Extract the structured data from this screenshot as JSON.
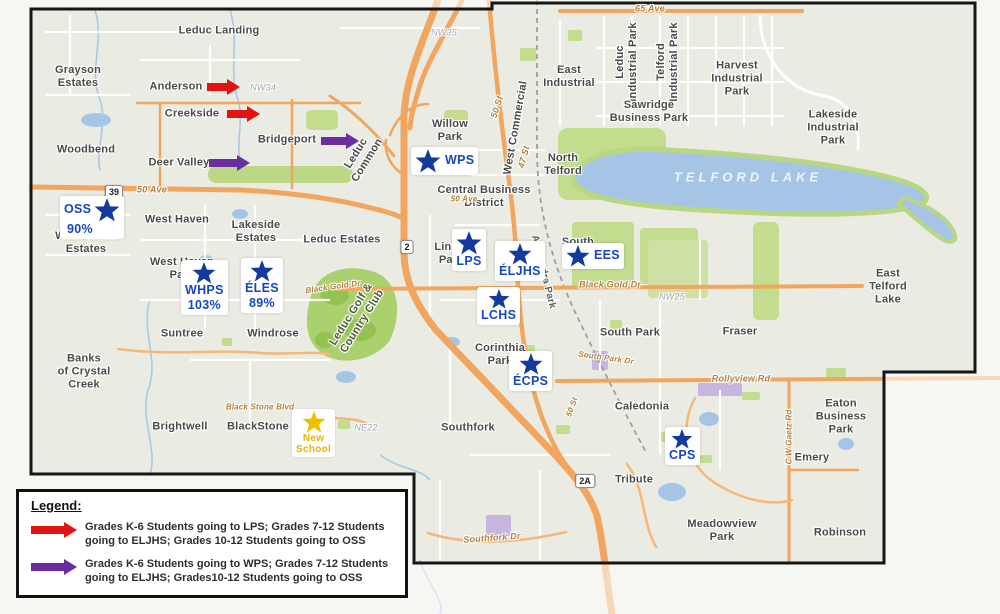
{
  "legend": {
    "title": "Legend:",
    "items": [
      {
        "color_name": "red",
        "arrow_color": "#e11414",
        "text": "Grades K-6 Students going to LPS; Grades 7-12 Students going to ELJHS; Grades 10-12 Students going to OSS"
      },
      {
        "color_name": "purple",
        "arrow_color": "#6b2ea0",
        "text": "Grades K-6 Students going to WPS; Grades 7-12 Students going to ELJHS; Grades10-12 Students going to OSS"
      }
    ]
  },
  "colors": {
    "school_blue": "#1646c6",
    "star_blue": "#143a9e",
    "new_school_yellow": "#f0c000",
    "new_school_text": "#e9b400",
    "arrow_red": "#e11414",
    "arrow_purple": "#6b2ea0",
    "highway_orange": "#f2a55e",
    "water_blue": "#a6c5e6",
    "park_green": "#c3dc8e",
    "boundary_black": "#161616"
  },
  "schools": [
    {
      "id": "OSS",
      "label": "OSS",
      "pct": "90%",
      "x": 60,
      "y": 196,
      "layout": "star-right",
      "star": 26
    },
    {
      "id": "WPS",
      "label": "WPS",
      "x": 411,
      "y": 147,
      "layout": "star-left",
      "star": 26
    },
    {
      "id": "WHPS",
      "label": "WHPS",
      "pct": "103%",
      "x": 181,
      "y": 260,
      "layout": "col",
      "star": 24
    },
    {
      "id": "ELES",
      "label": "ÉLES",
      "pct": "89%",
      "x": 241,
      "y": 258,
      "layout": "col",
      "star": 24
    },
    {
      "id": "LPS",
      "label": "LPS",
      "x": 452,
      "y": 229,
      "layout": "col",
      "star": 26
    },
    {
      "id": "ELJHS",
      "label": "ÉLJHS",
      "x": 495,
      "y": 241,
      "layout": "col",
      "star": 24
    },
    {
      "id": "EES",
      "label": "EES",
      "x": 562,
      "y": 243,
      "layout": "star-left",
      "star": 24
    },
    {
      "id": "LCHS",
      "label": "LCHS",
      "x": 477,
      "y": 287,
      "layout": "col",
      "star": 22
    },
    {
      "id": "ECPS",
      "label": "ÉCPS",
      "x": 509,
      "y": 351,
      "layout": "col",
      "star": 24
    },
    {
      "id": "CPS",
      "label": "CPS",
      "x": 665,
      "y": 427,
      "layout": "col",
      "star": 22
    },
    {
      "id": "NEW",
      "label": "New\nSchool",
      "x": 292,
      "y": 409,
      "layout": "col",
      "star": 24,
      "variant": "yellow"
    }
  ],
  "map_arrows": [
    {
      "name": "anderson-route-arrow",
      "color": "#e11414",
      "x": 207,
      "y": 87,
      "len": 33
    },
    {
      "name": "creekside-route-arrow",
      "color": "#e11414",
      "x": 227,
      "y": 114,
      "len": 33
    },
    {
      "name": "bridgeport-route-arrow",
      "color": "#6b2ea0",
      "x": 321,
      "y": 141,
      "len": 38
    },
    {
      "name": "deer-valley-route-arrow",
      "color": "#6b2ea0",
      "x": 209,
      "y": 163,
      "len": 41
    }
  ],
  "shields": [
    {
      "t": "39",
      "x": 114,
      "y": 192
    },
    {
      "t": "2",
      "x": 407,
      "y": 247
    },
    {
      "t": "2A",
      "x": 585,
      "y": 481
    }
  ],
  "labels": [
    {
      "n": "leduc-landing",
      "t": "Leduc Landing",
      "x": 219,
      "y": 31
    },
    {
      "n": "grayson-estates",
      "t": "Grayson\nEstates",
      "x": 78,
      "y": 77
    },
    {
      "n": "anderson",
      "t": "Anderson",
      "x": 176,
      "y": 87
    },
    {
      "n": "creekside",
      "t": "Creekside",
      "x": 192,
      "y": 114
    },
    {
      "n": "bridgeport",
      "t": "Bridgeport",
      "x": 287,
      "y": 140
    },
    {
      "n": "deer-valley",
      "t": "Deer Valley",
      "x": 179,
      "y": 163
    },
    {
      "n": "woodbend",
      "t": "Woodbend",
      "x": 86,
      "y": 150
    },
    {
      "n": "leduc-common",
      "t": "Leduc\nCommon",
      "x": 362,
      "y": 157,
      "r": -58
    },
    {
      "n": "willow-park",
      "t": "Willow\nPark",
      "x": 450,
      "y": 131
    },
    {
      "n": "west-commercial",
      "t": "West Commercial",
      "x": 516,
      "y": 128,
      "r": -80
    },
    {
      "n": "east-industrial",
      "t": "East\nIndustrial",
      "x": 569,
      "y": 77
    },
    {
      "n": "leduc-industrial-park",
      "t": "Leduc\nIndustrial Park",
      "x": 627,
      "y": 62,
      "r": -90
    },
    {
      "n": "telford-industrial-park",
      "t": "Telford\nIndustrial Park",
      "x": 668,
      "y": 62,
      "r": -90
    },
    {
      "n": "sawridge-business-park",
      "t": "Sawridge\nBusiness Park",
      "x": 649,
      "y": 112
    },
    {
      "n": "harvest-industrial-park",
      "t": "Harvest\nIndustrial\nPark",
      "x": 737,
      "y": 79
    },
    {
      "n": "lakeside-industrial-park",
      "t": "Lakeside\nIndustrial\nPark",
      "x": 833,
      "y": 128
    },
    {
      "n": "north-telford",
      "t": "North\nTelford",
      "x": 563,
      "y": 165
    },
    {
      "n": "central-business-district",
      "t": "Central Business\nDistrict",
      "x": 484,
      "y": 197
    },
    {
      "n": "west-creek-estates",
      "t": "West Creek\nEstates",
      "x": 86,
      "y": 243
    },
    {
      "n": "west-haven",
      "t": "West Haven",
      "x": 177,
      "y": 220
    },
    {
      "n": "lakeside-estates",
      "t": "Lakeside\nEstates",
      "x": 256,
      "y": 232
    },
    {
      "n": "leduc-estates",
      "t": "Leduc Estates",
      "x": 342,
      "y": 240
    },
    {
      "n": "west-haven-park",
      "t": "West Haven\nPark",
      "x": 182,
      "y": 269
    },
    {
      "n": "linsford-park",
      "t": "Linsf\nPar",
      "x": 448,
      "y": 254
    },
    {
      "n": "south-telford",
      "t": "South\nTe",
      "x": 578,
      "y": 249
    },
    {
      "n": "suntree",
      "t": "Suntree",
      "x": 182,
      "y": 334
    },
    {
      "n": "windrose",
      "t": "Windrose",
      "x": 273,
      "y": 334
    },
    {
      "n": "south-park",
      "t": "South Park",
      "x": 630,
      "y": 333
    },
    {
      "n": "fraser",
      "t": "Fraser",
      "x": 740,
      "y": 332
    },
    {
      "n": "east-telford-lake",
      "t": "East\nTelford\nLake",
      "x": 888,
      "y": 287
    },
    {
      "n": "corinthia-park",
      "t": "Corinthia\nPark",
      "x": 500,
      "y": 355
    },
    {
      "n": "banks-of-crystal-creek",
      "t": "Banks\nof Crystal\nCreek",
      "x": 84,
      "y": 372
    },
    {
      "n": "brightwell",
      "t": "Brightwell",
      "x": 180,
      "y": 427
    },
    {
      "n": "blackstone",
      "t": "BlackStone",
      "x": 258,
      "y": 427
    },
    {
      "n": "southfork",
      "t": "Southfork",
      "x": 468,
      "y": 428
    },
    {
      "n": "caledonia",
      "t": "Caledonia",
      "x": 642,
      "y": 407
    },
    {
      "n": "tribute",
      "t": "Tribute",
      "x": 634,
      "y": 480
    },
    {
      "n": "meadowview-park",
      "t": "Meadowview\nPark",
      "x": 722,
      "y": 531
    },
    {
      "n": "robinson",
      "t": "Robinson",
      "x": 840,
      "y": 533
    },
    {
      "n": "emery",
      "t": "Emery",
      "x": 812,
      "y": 458
    },
    {
      "n": "eaton-business-park",
      "t": "Eaton\nBusiness\nPark",
      "x": 841,
      "y": 417
    },
    {
      "n": "leduc-golf-country-club",
      "t": "Leduc Golf &\nCountry Club",
      "x": 357,
      "y": 318,
      "r": -58,
      "c": "golf"
    },
    {
      "n": "telford-lake",
      "t": "TELFORD LAKE",
      "x": 748,
      "y": 177,
      "c": "lake-label"
    },
    {
      "n": "alexandra-park",
      "t": "Alexandra Park",
      "x": 543,
      "y": 272,
      "r": 76,
      "c": "park-rot"
    },
    {
      "n": "65-ave",
      "t": "65 Ave",
      "x": 650,
      "y": 9,
      "c": "road"
    },
    {
      "n": "50-ave-west",
      "t": "50 Ave",
      "x": 152,
      "y": 190,
      "c": "road"
    },
    {
      "n": "50-ave-cbd",
      "t": "50 Ave",
      "x": 464,
      "y": 199,
      "c": "road road-sm"
    },
    {
      "n": "50-st",
      "t": "50 St",
      "x": 497,
      "y": 107,
      "r": -72,
      "c": "road"
    },
    {
      "n": "47-st",
      "t": "47 St",
      "x": 524,
      "y": 157,
      "r": -75,
      "c": "road"
    },
    {
      "n": "black-gold-dr",
      "t": "Black Gold Dr",
      "x": 610,
      "y": 285,
      "c": "road"
    },
    {
      "n": "black-gold-dr-w",
      "t": "Black Gold Dr",
      "x": 333,
      "y": 287,
      "r": -8,
      "c": "road road-sm"
    },
    {
      "n": "rollyview-rd",
      "t": "Rollyview Rd",
      "x": 741,
      "y": 379,
      "c": "road"
    },
    {
      "n": "cw-gaetz-rd",
      "t": "C W Gaetz Rd",
      "x": 789,
      "y": 437,
      "r": -90,
      "c": "road road-sm"
    },
    {
      "n": "south-park-dr",
      "t": "South Park Dr",
      "x": 606,
      "y": 358,
      "r": 8,
      "c": "road road-sm"
    },
    {
      "n": "southfork-dr",
      "t": "Southfork Dr",
      "x": 492,
      "y": 538,
      "r": -4,
      "c": "road"
    },
    {
      "n": "black-stone-blvd",
      "t": "Black Stone Blvd",
      "x": 260,
      "y": 407,
      "c": "road road-sm"
    },
    {
      "n": "50-st-south",
      "t": "50 St",
      "x": 572,
      "y": 407,
      "r": -70,
      "c": "road road-sm"
    },
    {
      "n": "nw35",
      "t": "NW35",
      "x": 444,
      "y": 33,
      "c": "grid"
    },
    {
      "n": "nw34",
      "t": "NW34",
      "x": 263,
      "y": 88,
      "c": "grid"
    },
    {
      "n": "nw25",
      "t": "NW25",
      "x": 672,
      "y": 297,
      "c": "grid"
    },
    {
      "n": "ne22",
      "t": "NE22",
      "x": 366,
      "y": 428,
      "c": "grid"
    }
  ]
}
